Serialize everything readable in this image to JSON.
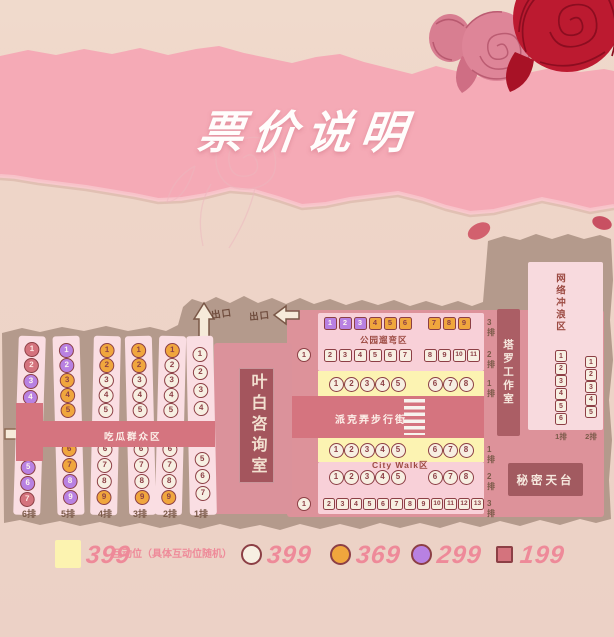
{
  "page": {
    "title": "票价说明"
  },
  "colors": {
    "tier_399": "#f7efe2",
    "tier_369": "#f0a63d",
    "tier_299": "#b881e2",
    "tier_199": "#d4737d",
    "interactive_bg": "#fcf3b2",
    "corridor_rose": "#d5747f",
    "room_dark": "#a4555d"
  },
  "legend": {
    "items": [
      {
        "swatch": "yellow-square",
        "price": "399",
        "note": "互动位（具体互动位随机）"
      },
      {
        "swatch": "white-circle",
        "price": "399"
      },
      {
        "swatch": "orange-circle",
        "price": "369"
      },
      {
        "swatch": "purple-circle",
        "price": "299"
      },
      {
        "swatch": "rose-square",
        "price": "199"
      }
    ]
  },
  "map": {
    "exits": {
      "up": "出口",
      "side": "出口"
    },
    "zones": {
      "left_area": "吃瓜群众区",
      "consult_room": "叶白咨询室",
      "park": "公园遛弯区",
      "street": "派克弄步行街",
      "citywalk": "City Walk区",
      "tarot": "塔罗工作室",
      "internet": "网络冲浪区",
      "rooftop": "秘密天台"
    },
    "left_block": {
      "rows": [
        {
          "label": "6排",
          "top": [
            [
              "1",
              "199"
            ],
            [
              "2",
              "199"
            ],
            [
              "3",
              "299"
            ],
            [
              "4",
              "299"
            ]
          ],
          "bottom": [
            [
              "5",
              "299"
            ],
            [
              "6",
              "299"
            ],
            [
              "7",
              "199"
            ]
          ]
        },
        {
          "label": "5排",
          "top": [
            [
              "1",
              "299"
            ],
            [
              "2",
              "299"
            ],
            [
              "3",
              "369"
            ],
            [
              "4",
              "369"
            ],
            [
              "5",
              "369"
            ]
          ],
          "bottom": [
            [
              "6",
              "369"
            ],
            [
              "7",
              "369"
            ],
            [
              "8",
              "299"
            ],
            [
              "9",
              "299"
            ]
          ]
        },
        {
          "label": "4排",
          "top": [
            [
              "1",
              "369"
            ],
            [
              "2",
              "369"
            ],
            [
              "3",
              "399"
            ],
            [
              "4",
              "399"
            ],
            [
              "5",
              "399"
            ]
          ],
          "bottom": [
            [
              "6",
              "399"
            ],
            [
              "7",
              "399"
            ],
            [
              "8",
              "399"
            ],
            [
              "9",
              "369"
            ]
          ]
        },
        {
          "label": "3排",
          "top": [
            [
              "1",
              "369"
            ],
            [
              "2",
              "369"
            ],
            [
              "3",
              "399"
            ],
            [
              "4",
              "399"
            ],
            [
              "5",
              "399"
            ]
          ],
          "bottom": [
            [
              "6",
              "399"
            ],
            [
              "7",
              "399"
            ],
            [
              "8",
              "399"
            ],
            [
              "9",
              "369"
            ]
          ]
        },
        {
          "label": "2排",
          "top": [
            [
              "1",
              "369"
            ],
            [
              "2",
              "399"
            ],
            [
              "3",
              "399"
            ],
            [
              "4",
              "399"
            ],
            [
              "5",
              "399"
            ]
          ],
          "bottom": [
            [
              "6",
              "399"
            ],
            [
              "7",
              "399"
            ],
            [
              "8",
              "399"
            ],
            [
              "9",
              "369"
            ]
          ]
        },
        {
          "label": "1排",
          "top": [
            [
              "1",
              "399"
            ],
            [
              "2",
              "399"
            ],
            [
              "3",
              "399"
            ],
            [
              "4",
              "399"
            ]
          ],
          "bottom": [
            [
              "5",
              "399"
            ],
            [
              "6",
              "399"
            ],
            [
              "7",
              "399"
            ]
          ]
        }
      ]
    },
    "park_block": {
      "rows": [
        {
          "label": "3排",
          "shape": "sq",
          "left": [
            [
              "1",
              "299"
            ],
            [
              "2",
              "299"
            ],
            [
              "3",
              "299"
            ],
            [
              "4",
              "369"
            ],
            [
              "5",
              "369"
            ],
            [
              "6",
              "369"
            ]
          ],
          "right": [
            [
              "7",
              "369"
            ],
            [
              "8",
              "369"
            ],
            [
              "9",
              "369"
            ]
          ]
        },
        {
          "label": "2排",
          "shape": "sq",
          "solo": [
            "1",
            "399"
          ],
          "left": [
            [
              "2",
              "399"
            ],
            [
              "3",
              "399"
            ],
            [
              "4",
              "399"
            ],
            [
              "5",
              "399"
            ],
            [
              "6",
              "399"
            ],
            [
              "7",
              "399"
            ]
          ],
          "right": [
            [
              "8",
              "399"
            ],
            [
              "9",
              "399"
            ],
            [
              "10",
              "399"
            ],
            [
              "11",
              "399"
            ]
          ]
        },
        {
          "label": "1排",
          "shape": "ci",
          "left": [
            [
              "1",
              "399"
            ],
            [
              "2",
              "399"
            ],
            [
              "3",
              "399"
            ],
            [
              "4",
              "399"
            ],
            [
              "5",
              "399"
            ]
          ],
          "right": [
            [
              "6",
              "399"
            ],
            [
              "7",
              "399"
            ],
            [
              "8",
              "399"
            ]
          ]
        }
      ]
    },
    "citywalk_block": {
      "rows": [
        {
          "label": "1排",
          "shape": "ci",
          "left": [
            [
              "1",
              "399"
            ],
            [
              "2",
              "399"
            ],
            [
              "3",
              "399"
            ],
            [
              "4",
              "399"
            ],
            [
              "5",
              "399"
            ]
          ],
          "right": [
            [
              "6",
              "399"
            ],
            [
              "7",
              "399"
            ],
            [
              "8",
              "399"
            ]
          ]
        },
        {
          "label": "2排",
          "shape": "ci",
          "left": [
            [
              "1",
              "399"
            ],
            [
              "2",
              "399"
            ],
            [
              "3",
              "399"
            ],
            [
              "4",
              "399"
            ],
            [
              "5",
              "399"
            ]
          ],
          "right": [
            [
              "6",
              "399"
            ],
            [
              "7",
              "399"
            ],
            [
              "8",
              "399"
            ]
          ]
        },
        {
          "label": "3排",
          "shape": "sq",
          "solo": [
            "1",
            "399"
          ],
          "squares": [
            [
              "2",
              "399"
            ],
            [
              "3",
              "399"
            ],
            [
              "4",
              "399"
            ],
            [
              "5",
              "399"
            ],
            [
              "6",
              "399"
            ],
            [
              "7",
              "399"
            ],
            [
              "8",
              "399"
            ],
            [
              "9",
              "399"
            ],
            [
              "10",
              "399"
            ],
            [
              "11",
              "399"
            ],
            [
              "12",
              "399"
            ],
            [
              "13",
              "399"
            ]
          ]
        }
      ]
    },
    "internet_block": {
      "cols": [
        {
          "label": "1排",
          "seats": [
            [
              "1",
              "399"
            ],
            [
              "2",
              "399"
            ],
            [
              "3",
              "399"
            ],
            [
              "4",
              "399"
            ],
            [
              "5",
              "399"
            ],
            [
              "6",
              "399"
            ]
          ]
        },
        {
          "label": "2排",
          "seats": [
            [
              "1",
              "399"
            ],
            [
              "2",
              "399"
            ],
            [
              "3",
              "399"
            ],
            [
              "4",
              "399"
            ],
            [
              "5",
              "399"
            ]
          ]
        }
      ]
    }
  }
}
